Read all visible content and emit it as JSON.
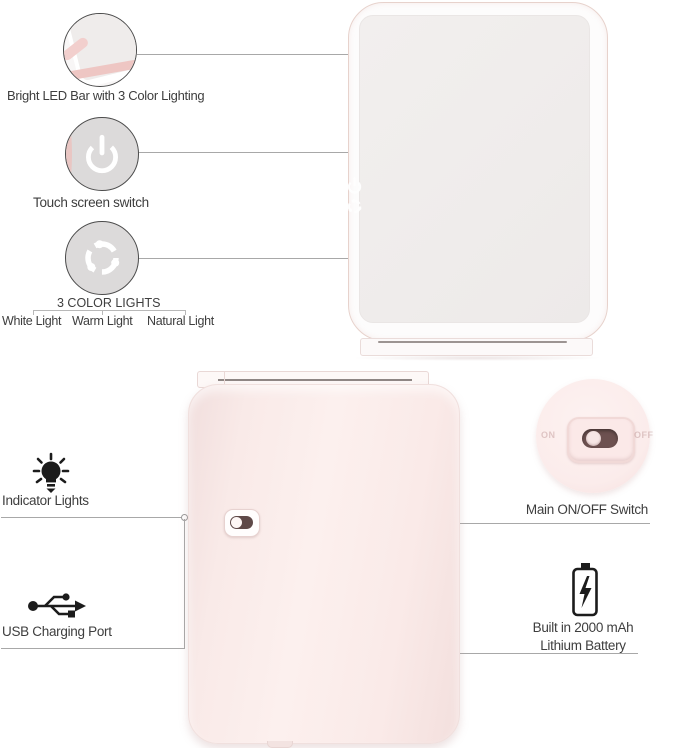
{
  "colors": {
    "pink_device": "#f8e9e7",
    "pink_accent": "#eec6c3",
    "screen_gray": "#f0edec",
    "circle_gray": "#dcdada",
    "line_gray": "#a8a8a8",
    "text_dark": "#3e3e3e",
    "icon_black": "#1c1c1c",
    "switch_slot": "#5f4948",
    "magnifier_pink": "#fbeceb"
  },
  "callouts": {
    "led_bar": {
      "label": "Bright LED Bar with 3 Color Lighting"
    },
    "touch_switch": {
      "label": "Touch screen switch"
    },
    "color_lights": {
      "title": "3 COLOR LIGHTS",
      "options": [
        "White Light",
        "Warm Light",
        "Natural Light"
      ]
    },
    "indicator_lights": {
      "label": "Indicator Lights"
    },
    "usb_port": {
      "label": "USB Charging Port"
    },
    "main_switch": {
      "label": "Main ON/OFF Switch",
      "on_label": "ON",
      "off_label": "OFF"
    },
    "battery": {
      "line1": "Built in 2000 mAh",
      "line2": "Lithium Battery"
    }
  },
  "icons": {
    "power": "power-icon",
    "color_lights": "color-lights-icon",
    "bulb": "indicator-bulb-icon",
    "usb": "usb-icon",
    "battery": "battery-icon"
  }
}
